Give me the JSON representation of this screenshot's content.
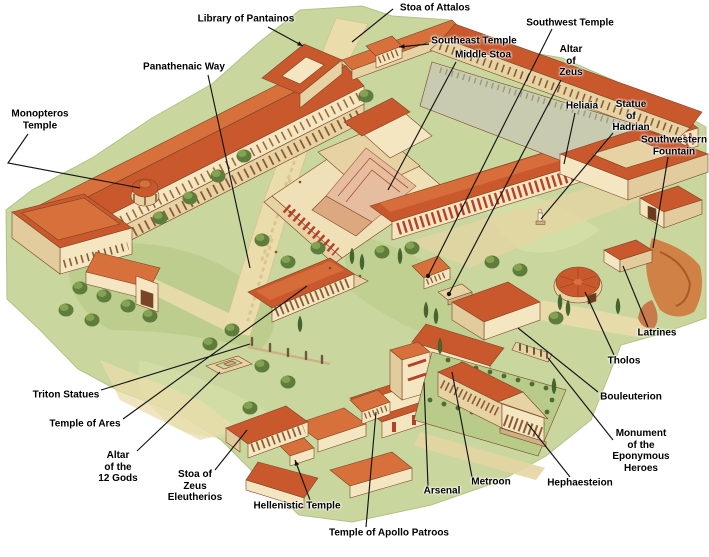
{
  "canvas": {
    "width": 709,
    "height": 557
  },
  "palette": {
    "background": "#ffffff",
    "grass": "#c9d69e",
    "grass_dark": "#b9cb88",
    "grass_light": "#d4e0a8",
    "path": "#eadcab",
    "roof": "#c9582c",
    "roof_light": "#d8703c",
    "wall": "#f4e6c1",
    "wall_shadow": "#e2cb9c",
    "column_red": "#b8402a",
    "tree": "#5e7d3d",
    "cypress": "#47662f",
    "rock": "#cf8146",
    "label_text": "#000000",
    "leader_line": "#141414"
  },
  "map_labels": [
    {
      "id": "library-of-pantainos",
      "text": "Library of Pantainos",
      "x": 246,
      "y": 19,
      "leader": [
        [
          268,
          27
        ],
        [
          303,
          46
        ]
      ],
      "end": "arrow"
    },
    {
      "id": "stoa-of-attalos",
      "text": "Stoa of Attalos",
      "x": 435,
      "y": 8,
      "leader": [
        [
          393,
          9
        ],
        [
          352,
          42
        ]
      ],
      "end": "none"
    },
    {
      "id": "southwest-temple",
      "text": "Southwest Temple",
      "x": 570,
      "y": 23,
      "leader": [
        [
          552,
          29
        ],
        [
          428,
          276
        ]
      ],
      "end": "dot"
    },
    {
      "id": "southeast-temple",
      "text": "Southeast Temple",
      "x": 474,
      "y": 41,
      "leader": [
        [
          429,
          44
        ],
        [
          399,
          47
        ]
      ],
      "end": "arrow"
    },
    {
      "id": "middle-stoa",
      "text": "Middle Stoa",
      "x": 483,
      "y": 55,
      "leader": [
        [
          456,
          62
        ],
        [
          388,
          190
        ]
      ],
      "end": "none"
    },
    {
      "id": "altar-of-zeus",
      "text": "Altar\nof\nZeus",
      "x": 571,
      "y": 61,
      "leader": [
        [
          561,
          80
        ],
        [
          449,
          294
        ]
      ],
      "end": "dot"
    },
    {
      "id": "panathenaic-way",
      "text": "Panathenaic Way",
      "x": 184,
      "y": 67,
      "leader": [
        [
          208,
          75
        ],
        [
          250,
          268
        ]
      ],
      "end": "none"
    },
    {
      "id": "heliaia",
      "text": "Heliaia",
      "x": 582,
      "y": 106,
      "leader": [
        [
          575,
          113
        ],
        [
          564,
          164
        ]
      ],
      "end": "none"
    },
    {
      "id": "statue-of-hadrian",
      "text": "Statue\nof\nHadrian",
      "x": 631,
      "y": 116,
      "leader": [
        [
          613,
          133
        ],
        [
          541,
          219
        ]
      ],
      "end": "none"
    },
    {
      "id": "monopteros-temple",
      "text": "Monopteros\nTemple",
      "x": 40,
      "y": 120,
      "leader": [
        [
          28,
          134
        ],
        [
          8,
          163
        ],
        [
          140,
          188
        ]
      ],
      "end": "none"
    },
    {
      "id": "southwestern-fountain",
      "text": "Southwestern\nFountain",
      "x": 674,
      "y": 146,
      "leader": [
        [
          668,
          157
        ],
        [
          653,
          248
        ]
      ],
      "end": "none"
    },
    {
      "id": "latrines",
      "text": "Latrines",
      "x": 657,
      "y": 333,
      "leader": [
        [
          648,
          327
        ],
        [
          623,
          266
        ]
      ],
      "end": "none"
    },
    {
      "id": "tholos",
      "text": "Tholos",
      "x": 624,
      "y": 361,
      "leader": [
        [
          614,
          355
        ],
        [
          585,
          292
        ]
      ],
      "end": "none"
    },
    {
      "id": "triton-statues",
      "text": "Triton Statues",
      "x": 66,
      "y": 395,
      "leader": [
        [
          101,
          390
        ],
        [
          250,
          344
        ]
      ],
      "end": "none"
    },
    {
      "id": "bouleuterion",
      "text": "Bouleuterion",
      "x": 631,
      "y": 397,
      "leader": [
        [
          598,
          392
        ],
        [
          518,
          328
        ]
      ],
      "end": "none"
    },
    {
      "id": "temple-of-ares",
      "text": "Temple of Ares",
      "x": 85,
      "y": 424,
      "leader": [
        [
          123,
          419
        ],
        [
          307,
          286
        ]
      ],
      "end": "none"
    },
    {
      "id": "monument-of-the-eponymous-heroes",
      "text": "Monument\nof the\nEponymous\nHeroes",
      "x": 641,
      "y": 451,
      "leader": [
        [
          613,
          440
        ],
        [
          548,
          358
        ]
      ],
      "end": "none"
    },
    {
      "id": "altar-of-the-12-gods",
      "text": "Altar\nof the\n12 Gods",
      "x": 118,
      "y": 467,
      "leader": [
        [
          137,
          451
        ],
        [
          220,
          372
        ]
      ],
      "end": "none"
    },
    {
      "id": "stoa-of-zeus-eleutherios",
      "text": "Stoa of\nZeus\nEleutherios",
      "x": 195,
      "y": 486,
      "leader": [
        [
          215,
          470
        ],
        [
          247,
          430
        ]
      ],
      "end": "none"
    },
    {
      "id": "hephaesteion",
      "text": "Hephaesteion",
      "x": 580,
      "y": 483,
      "leader": [
        [
          570,
          477
        ],
        [
          528,
          424
        ]
      ],
      "end": "none"
    },
    {
      "id": "metroon",
      "text": "Metroon",
      "x": 491,
      "y": 482,
      "leader": [
        [
          472,
          477
        ],
        [
          452,
          372
        ]
      ],
      "end": "none"
    },
    {
      "id": "arsenal",
      "text": "Arsenal",
      "x": 442,
      "y": 491,
      "leader": [
        [
          428,
          486
        ],
        [
          424,
          382
        ]
      ],
      "end": "none"
    },
    {
      "id": "hellenistic-temple",
      "text": "Hellenistic Temple",
      "x": 297,
      "y": 506,
      "leader": [
        [
          310,
          500
        ],
        [
          295,
          460
        ]
      ],
      "end": "arrow"
    },
    {
      "id": "temple-of-apollo-patroos",
      "text": "Temple of Apollo Patroos",
      "x": 389,
      "y": 533,
      "leader": [
        [
          366,
          527
        ],
        [
          376,
          412
        ]
      ],
      "end": "none"
    }
  ]
}
